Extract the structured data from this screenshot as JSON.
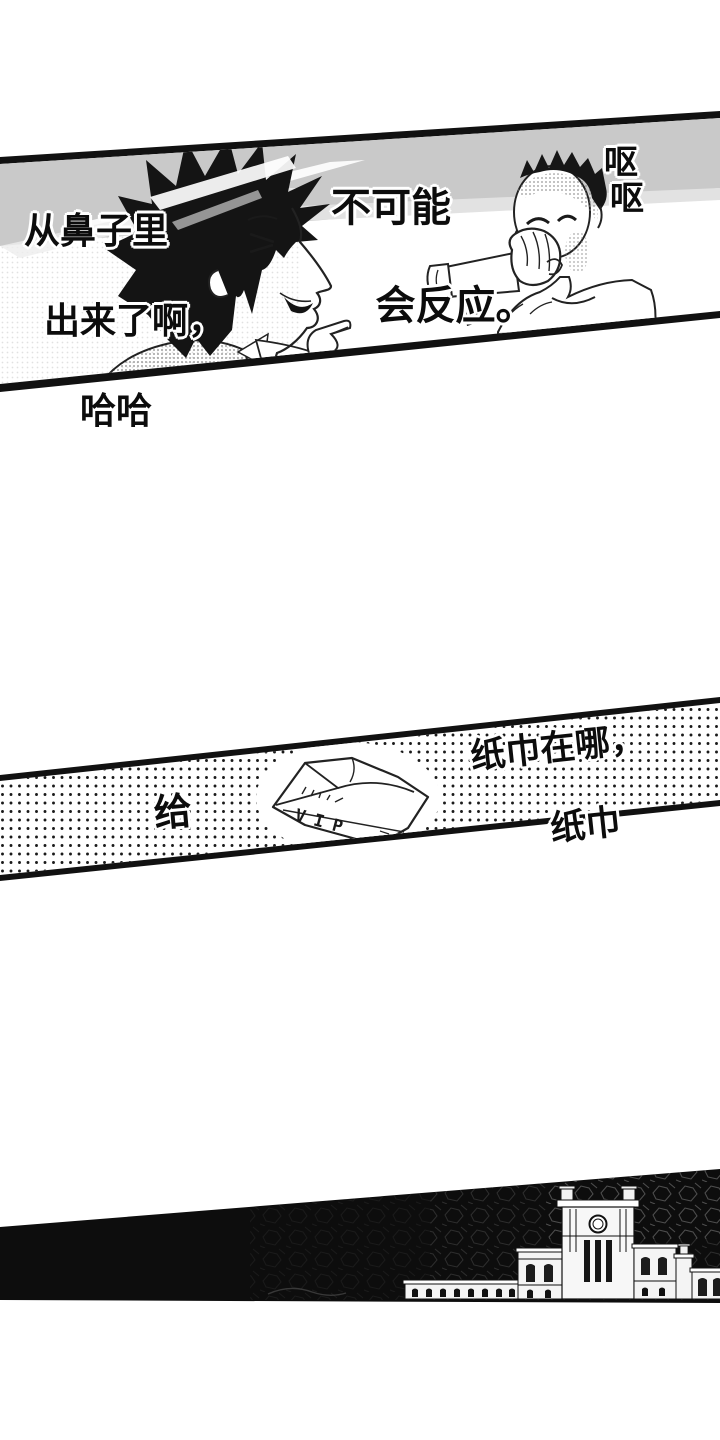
{
  "colors": {
    "ink": "#111111",
    "paper": "#ffffff",
    "halftone_band_gray": "#c9c9c9",
    "polka_dot": "#1a1a1a",
    "night_black": "#0d0d0d"
  },
  "illustrations": {
    "panel1": "two-men-talking-illustration",
    "panel2": "crumpled-vip-napkin-illustration",
    "panel3": "palace-building-night-illustration"
  },
  "panel1": {
    "speech_left": {
      "line1": "从鼻子里",
      "line2": "出来了啊，",
      "line3": "哈哈"
    },
    "speech_center": {
      "line1": "不可能",
      "line2": "会反应。"
    },
    "sfx_right": {
      "char1": "呕",
      "char2": "呕"
    }
  },
  "panel2": {
    "speech_give": "给",
    "speech_right": {
      "line1": "纸巾在哪，",
      "line2": "纸巾"
    },
    "napkin_label": "VIP"
  }
}
